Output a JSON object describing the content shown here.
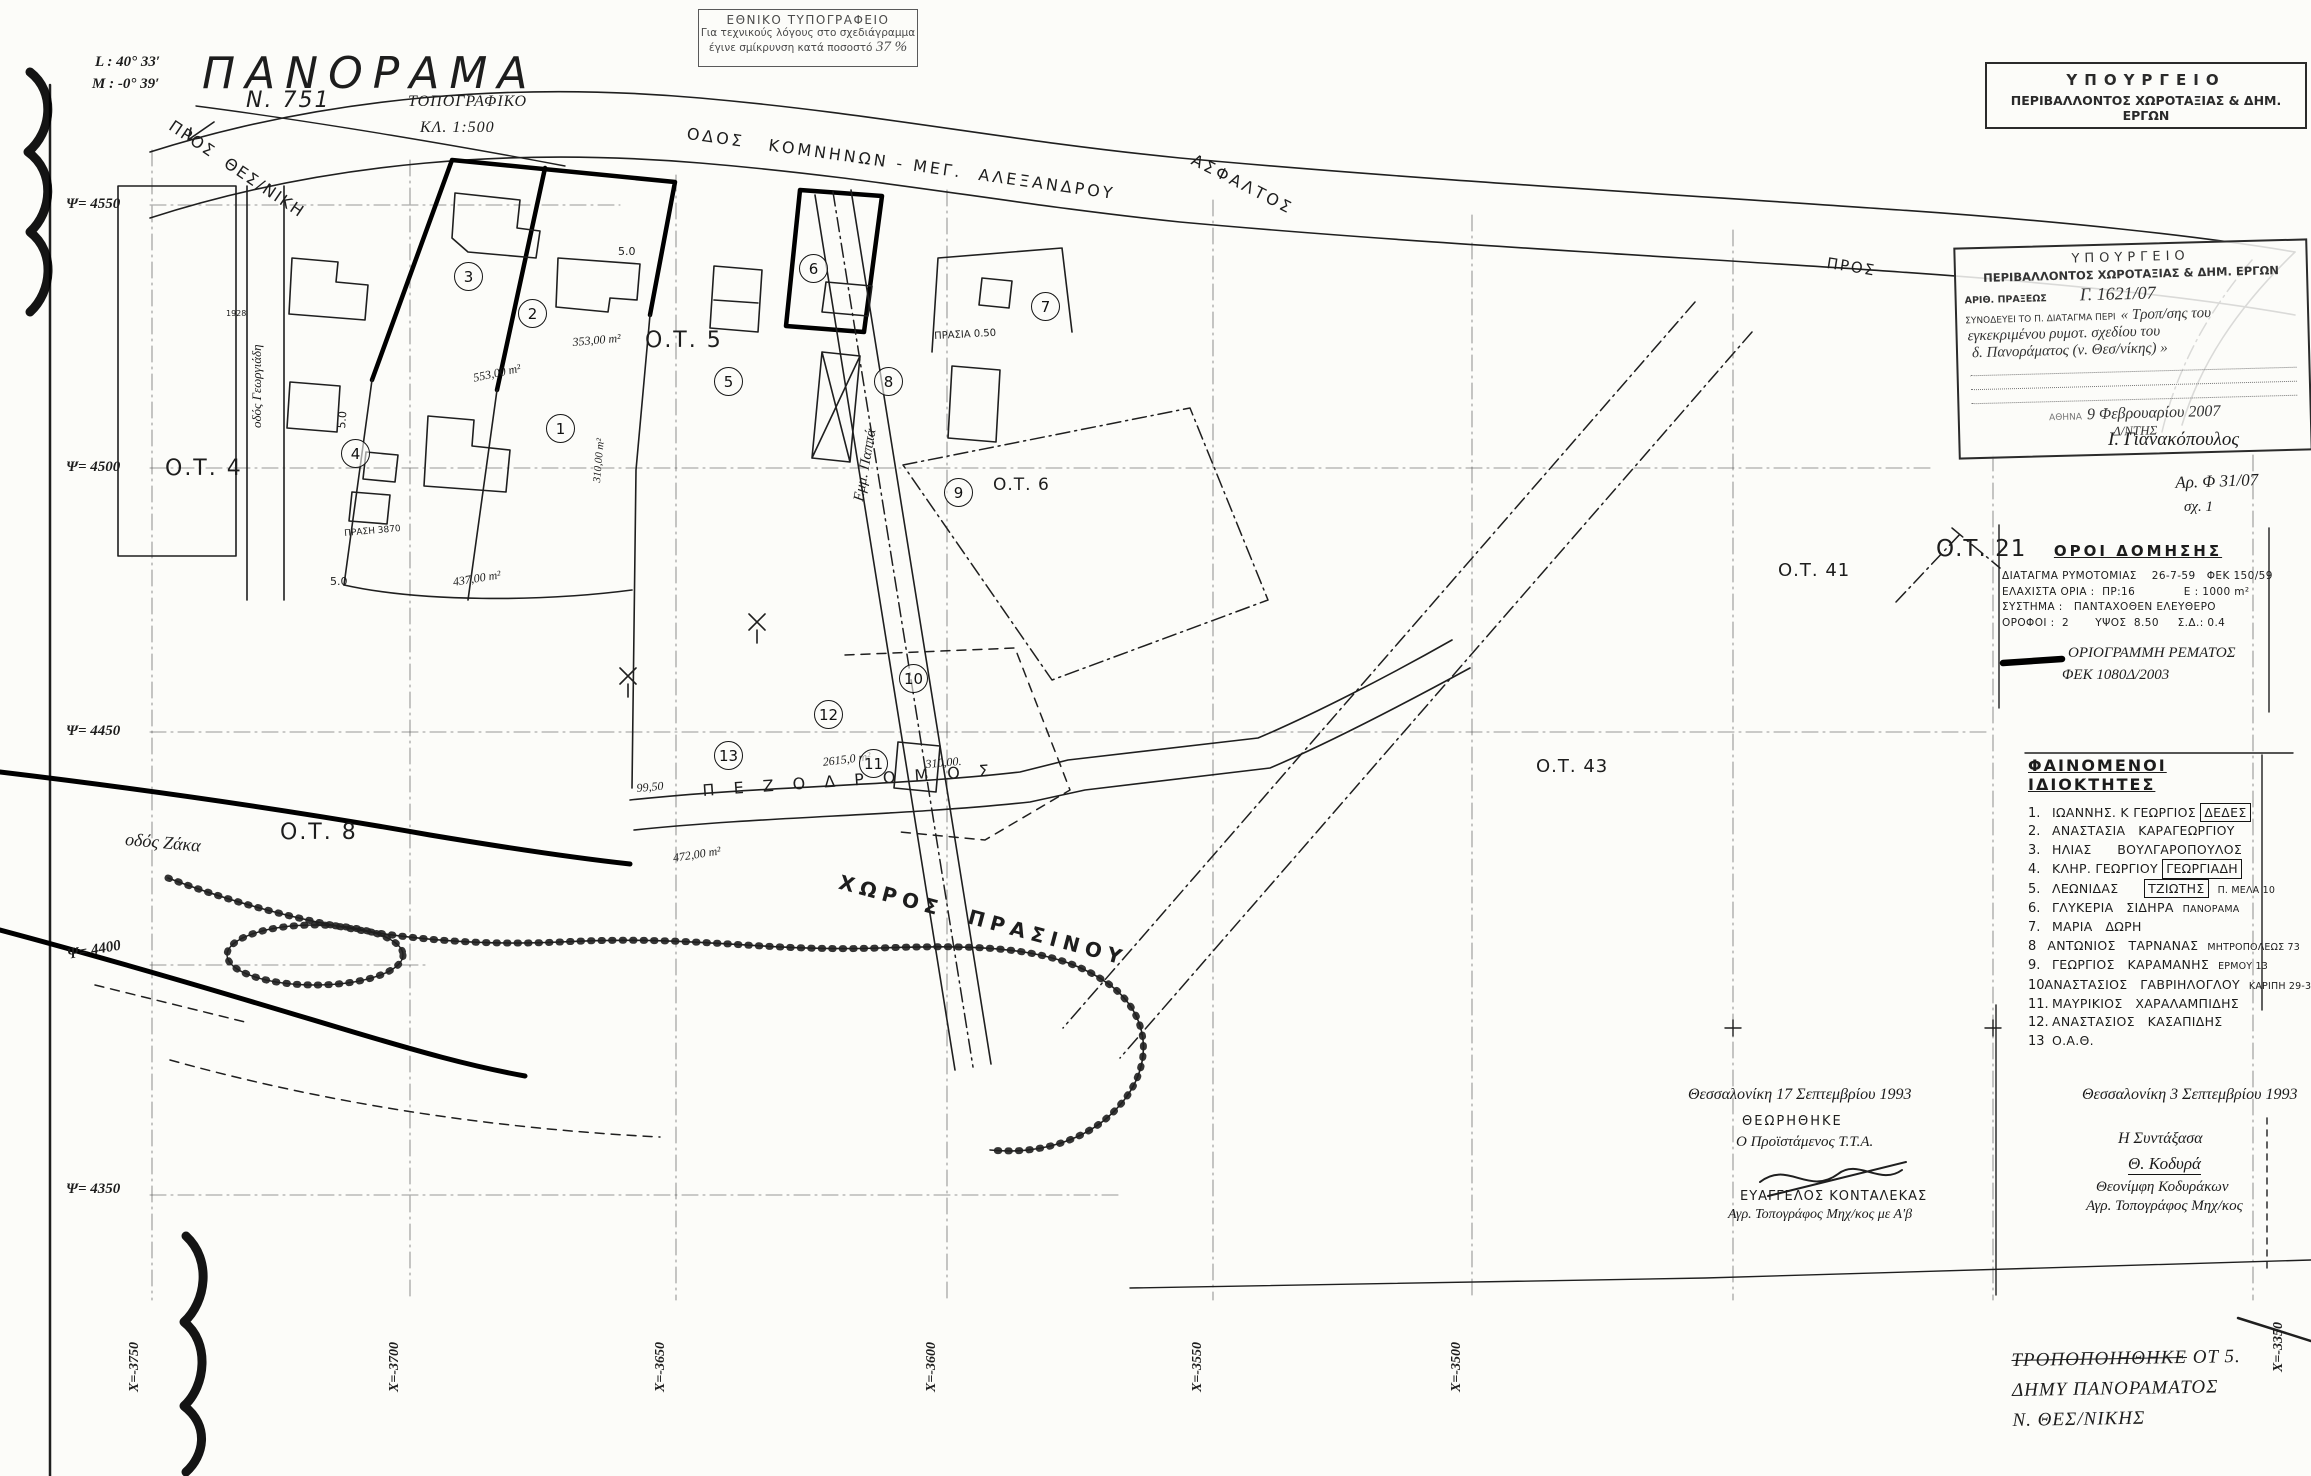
{
  "print_stamp": {
    "line1": "ΕΘΝΙΚΟ ΤΥΠΟΓΡΑΦΕΙΟ",
    "line2": "Για τεχνικούς λόγους στο σχεδιάγραμμα",
    "line3": "έγινε σμίκρυνση κατά ποσοστό",
    "percent": "37 %"
  },
  "title_block": {
    "l_coord": "L : 40° 33′",
    "m_coord": "M : -0° 39′",
    "title": "ΠΑΝΟΡΑΜΑ",
    "map_no": "N. 751",
    "type": "ΤΟΠΟΓΡΑΦΙΚΟ",
    "scale": "ΚΛ. 1:500"
  },
  "ministry_header": {
    "line1": "ΥΠΟΥΡΓΕΙΟ",
    "line2": "ΠΕΡΙΒΑΛΛΟΝΤΟΣ ΧΩΡΟΤΑΞΙΑΣ & ΔΗΜ. ΕΡΓΩΝ"
  },
  "approval_stamp": {
    "line1": "ΥΠΟΥΡΓΕΙΟ",
    "line2": "ΠΕΡΙΒΑΛΛΟΝΤΟΣ ΧΩΡΟΤΑΞΙΑΣ & ΔΗΜ. ΕΡΓΩΝ",
    "act_label": "ΑΡΙΘ. ΠΡΑΞΕΩΣ",
    "act_no": "Γ. 1621/07",
    "decree_label": "ΣΥΝΟΔΕΥΕΙ ΤΟ Π. ΔΙΑΤΑΓΜΑ ΠΕΡΙ",
    "subject1": "« Τροπ/σης του",
    "subject2": "εγκεκριμένου ρυμοτ. σχεδίου του",
    "subject3": "δ. Πανοράματος (ν. Θεσ/νίκης) »",
    "city_label": "ΑΘΗΝΑ",
    "date": "9 Φεβρουαρίου 2007",
    "role": "Δ/ΝΤΗΣ",
    "signature": "Ι. Γιανακόπουλος"
  },
  "file_notes": {
    "file_no": "Αρ. Φ 31/07",
    "sheet": "σχ. 1"
  },
  "building_terms": {
    "title": "ΟΡΟΙ  ΔΟΜΗΣΗΣ",
    "rows": [
      "ΔΙΑΤΑΓΜΑ ΡΥΜΟΤΟΜΙΑΣ    26-7-59   ΦΕΚ 150/59",
      "ΕΛΑΧΙΣΤΑ ΟΡΙΑ :  ΠΡ:16             Ε : 1000 m²",
      "ΣΥΣΤΗΜΑ :   ΠΑΝΤΑΧΟΘΕΝ ΕΛΕΥΘΕΡΟ",
      "ΟΡΟΦΟΙ :  2       ΥΨΟΣ  8.50     Σ.Δ.: 0.4"
    ],
    "legend_text1": "ΟΡΙΟΓΡΑΜΜΗ ΡΕΜΑΤΟΣ",
    "legend_text2": "ΦΕΚ 1080Δ/2003"
  },
  "owners": {
    "title": "ΦΑΙΝΟΜΕΝΟΙ  ΙΔΙΟΚΤΗΤΕΣ",
    "items": [
      {
        "no": "1.",
        "pre": "ΙΩΑΝΝΗΣ. Κ ΓΕΩΡΓΙΟΣ ",
        "boxed": "ΔΕΔΕΣ",
        "note": ""
      },
      {
        "no": "2.",
        "pre": "ΑΝΑΣΤΑΣΙΑ   ΚΑΡΑΓΕΩΡΓΙΟΥ",
        "boxed": "",
        "note": ""
      },
      {
        "no": "3.",
        "pre": "ΗΛΙΑΣ      ΒΟΥΛΓΑΡΟΠΟΥΛΟΣ",
        "boxed": "",
        "note": ""
      },
      {
        "no": "4.",
        "pre": "ΚΛΗΡ. ΓΕΩΡΓΙΟΥ ",
        "boxed": "ΓΕΩΡΓΙΑΔΗ",
        "note": ""
      },
      {
        "no": "5.",
        "pre": "ΛΕΩΝΙΔΑΣ      ",
        "boxed": "ΤΖΙΩΤΗΣ",
        "note": "Π. ΜΕΛΑ 10"
      },
      {
        "no": "6.",
        "pre": "ΓΛΥΚΕΡΙΑ   ΣΙΔΗΡΑ",
        "boxed": "",
        "note": "ΠΑΝΟΡΑΜΑ"
      },
      {
        "no": "7.",
        "pre": "ΜΑΡΙΑ   ΔΩΡΗ",
        "boxed": "",
        "note": ""
      },
      {
        "no": "8",
        "pre": "ΑΝΤΩΝΙΟΣ   ΤΑΡΝΑΝΑΣ",
        "boxed": "",
        "note": "ΜΗΤΡΟΠΟΛΕΩΣ 73"
      },
      {
        "no": "9.",
        "pre": "ΓΕΩΡΓΙΟΣ   ΚΑΡΑΜΑΝΗΣ",
        "boxed": "",
        "note": "ΕΡΜΟΥ 13"
      },
      {
        "no": "10",
        "pre": "ΑΝΑΣΤΑΣΙΟΣ   ΓΑΒΡΙΗΛΟΓΛΟΥ",
        "boxed": "",
        "note": "ΚΑΡΙΠΗ 29-31"
      },
      {
        "no": "11.",
        "pre": "ΜΑΥΡΙΚΙΟΣ   ΧΑΡΑΛΑΜΠΙΔΗΣ",
        "boxed": "",
        "note": ""
      },
      {
        "no": "12.",
        "pre": "ΑΝΑΣΤΑΣΙΟΣ   ΚΑΣΑΠΙΔΗΣ",
        "boxed": "",
        "note": ""
      },
      {
        "no": "13",
        "pre": "Ο.Α.Θ.",
        "boxed": "",
        "note": ""
      }
    ]
  },
  "signatures": {
    "left": {
      "date": "Θεσσαλονίκη  17 Σεπτεμβρίου 1993",
      "approved": "ΘΕΩΡΗΘΗΚΕ",
      "role": "Ο Προϊστάμενος Τ.Τ.Α.",
      "name": "ΕΥΑΓΓΕΛΟΣ  ΚΟΝΤΑΛΕΚΑΣ",
      "title": "Αγρ. Τοπογράφος Μηχ/κος με Α'β"
    },
    "right": {
      "date": "Θεσσαλονίκη  3 Σεπτεμβρίου 1993",
      "role": "Η Συντάξασα",
      "signature": "Θ. Κοδυρά",
      "name": "Θεονίμφη  Κοδυράκων",
      "title": "Αγρ. Τοπογράφος Μηχ/κος"
    }
  },
  "revision_note": {
    "line1_strike": "ΤΡΟΠΟΠΟΙΗΘΗΚΕ",
    "line1_rest": " ΟΤ 5.",
    "line2": "ΔΗΜΥ ΠΑΝΟΡΑΜΑΤΟΣ",
    "line3": "Ν. ΘΕΣ/ΝΙΚΗΣ"
  },
  "map": {
    "grid_y_labels": [
      {
        "t": "Ψ= 4550",
        "y": 197
      },
      {
        "t": "Ψ= 4500",
        "y": 460
      },
      {
        "t": "Ψ= 4450",
        "y": 724
      },
      {
        "t": "Ψ= 4400",
        "y": 948,
        "rot": -10
      },
      {
        "t": "Ψ= 4350",
        "y": 1182
      }
    ],
    "grid_x_labels": [
      {
        "t": "Χ=-3750",
        "x": 128
      },
      {
        "t": "Χ=-3700",
        "x": 388
      },
      {
        "t": "Χ=-3650",
        "x": 654
      },
      {
        "t": "Χ=-3600",
        "x": 925
      },
      {
        "t": "Χ=-3550",
        "x": 1191
      },
      {
        "t": "Χ=-3500",
        "x": 1450
      },
      {
        "t": "Χ=-3350",
        "x": 2272,
        "y": 1372
      }
    ],
    "parcel_numbers": [
      {
        "n": "1",
        "x": 560,
        "y": 428
      },
      {
        "n": "2",
        "x": 532,
        "y": 313
      },
      {
        "n": "3",
        "x": 468,
        "y": 276
      },
      {
        "n": "4",
        "x": 355,
        "y": 453
      },
      {
        "n": "5",
        "x": 728,
        "y": 381
      },
      {
        "n": "6",
        "x": 813,
        "y": 268
      },
      {
        "n": "7",
        "x": 1045,
        "y": 306
      },
      {
        "n": "8",
        "x": 888,
        "y": 381
      },
      {
        "n": "9",
        "x": 958,
        "y": 492
      },
      {
        "n": "10",
        "x": 913,
        "y": 678
      },
      {
        "n": "11",
        "x": 873,
        "y": 763
      },
      {
        "n": "12",
        "x": 828,
        "y": 714
      },
      {
        "n": "13",
        "x": 728,
        "y": 755
      }
    ],
    "labels": [
      {
        "t": "ΠΡΟΣ  ΘΕΣ/ΝΙΚΗ",
        "x": 175,
        "y": 118,
        "fs": 16,
        "rot": 34,
        "ls": 2,
        "name": "road-label-pros-thesniki"
      },
      {
        "t": "ΟΔΟΣ   ΚΟΜΝΗΝΩΝ - ΜΕΓ.  ΑΛΕΞΑΝΔΡΟΥ",
        "x": 688,
        "y": 126,
        "fs": 16,
        "rot": 8,
        "ls": 3,
        "name": "road-label-komninon-meg-alexandrou"
      },
      {
        "t": "ΑΣΦΑΛΤΟΣ",
        "x": 1196,
        "y": 152,
        "fs": 16,
        "rot": 27,
        "ls": 3,
        "name": "road-label-asfaltos"
      },
      {
        "t": "ΠΡΟΣ",
        "x": 1828,
        "y": 256,
        "fs": 15,
        "rot": 9,
        "ls": 2,
        "name": "road-label-pros"
      },
      {
        "t": "Π Ε Ζ Ο Δ Ρ Ο Μ Ο Σ",
        "x": 702,
        "y": 783,
        "fs": 16,
        "rot": -4,
        "ls": 7,
        "name": "road-label-pezodromos"
      },
      {
        "t": "ΧΩΡΟΣ  ΠΡΑΣΙΝΟΥ",
        "x": 842,
        "y": 872,
        "fs": 20,
        "rot": 15,
        "ls": 6,
        "cls": "b",
        "name": "area-label-green-space"
      },
      {
        "t": "Εμμ. Παππά",
        "x": 852,
        "y": 500,
        "fs": 15,
        "rot": -80,
        "cls": "hand",
        "name": "street-label-emm-pappa"
      },
      {
        "t": "οδός Ζάκα",
        "x": 126,
        "y": 830,
        "fs": 18,
        "rot": 5,
        "cls": "hand",
        "name": "street-label-zaka"
      },
      {
        "t": "οδός Γεωργιάδη",
        "x": 250,
        "y": 428,
        "fs": 13,
        "rot": -90,
        "cls": "hand",
        "name": "street-label-georgiadi"
      },
      {
        "t": "ΠΡΑΣΙΑ 0.50",
        "x": 934,
        "y": 332,
        "fs": 10,
        "rot": -3,
        "name": "label-prasia"
      },
      {
        "t": "Ο.Τ. 4",
        "x": 165,
        "y": 458,
        "fs": 22,
        "ls": 2,
        "name": "block-label-ot4"
      },
      {
        "t": "Ο.Τ. 5",
        "x": 645,
        "y": 330,
        "fs": 22,
        "ls": 2,
        "name": "block-label-ot5"
      },
      {
        "t": "Ο.Τ. 6",
        "x": 993,
        "y": 477,
        "fs": 17,
        "ls": 1,
        "name": "block-label-ot6"
      },
      {
        "t": "Ο.Τ. 8",
        "x": 280,
        "y": 822,
        "fs": 22,
        "ls": 2,
        "name": "block-label-ot8"
      },
      {
        "t": "Ο.Τ. 21",
        "x": 1936,
        "y": 538,
        "fs": 23,
        "ls": 1,
        "name": "block-label-ot21"
      },
      {
        "t": "Ο.Τ. 41",
        "x": 1778,
        "y": 562,
        "fs": 18,
        "ls": 1,
        "name": "block-label-ot41"
      },
      {
        "t": "Ο.Τ. 43",
        "x": 1536,
        "y": 758,
        "fs": 18,
        "ls": 1,
        "name": "block-label-ot43"
      },
      {
        "t": "353,00 m²",
        "x": 572,
        "y": 336,
        "fs": 12,
        "rot": -5,
        "cls": "hand",
        "name": "area-measure-353"
      },
      {
        "t": "553,00 m²",
        "x": 472,
        "y": 372,
        "fs": 12,
        "rot": -12,
        "cls": "hand",
        "name": "area-measure-553"
      },
      {
        "t": "310,00 m²",
        "x": 592,
        "y": 482,
        "fs": 11,
        "rot": -85,
        "cls": "hand",
        "name": "area-measure-310-vertical"
      },
      {
        "t": "2615,0 m²",
        "x": 822,
        "y": 756,
        "fs": 12,
        "rot": -7,
        "cls": "hand",
        "name": "area-measure-2615"
      },
      {
        "t": "310,00.",
        "x": 925,
        "y": 758,
        "fs": 12,
        "rot": -5,
        "cls": "hand",
        "name": "length-measure-310"
      },
      {
        "t": "99,50",
        "x": 636,
        "y": 782,
        "fs": 12,
        "rot": -5,
        "cls": "hand",
        "name": "length-measure-9950"
      },
      {
        "t": "472,00 m²",
        "x": 672,
        "y": 852,
        "fs": 12,
        "rot": -9,
        "cls": "hand",
        "name": "area-measure-472"
      },
      {
        "t": "437,00 m²",
        "x": 452,
        "y": 576,
        "fs": 12,
        "rot": -9,
        "cls": "hand",
        "name": "area-measure-437"
      },
      {
        "t": "5.0",
        "x": 618,
        "y": 246,
        "fs": 11,
        "name": "width-measure"
      },
      {
        "t": "5.0",
        "x": 336,
        "y": 428,
        "fs": 11,
        "rot": -85,
        "name": "width-measure"
      },
      {
        "t": "5.0",
        "x": 330,
        "y": 576,
        "fs": 11,
        "name": "width-measure"
      },
      {
        "t": "ΠΡΑΣΗ 3870",
        "x": 344,
        "y": 530,
        "fs": 9,
        "rot": -5,
        "name": "survey-point"
      },
      {
        "t": "1928",
        "x": 226,
        "y": 310,
        "fs": 8,
        "name": "survey-point"
      }
    ]
  }
}
